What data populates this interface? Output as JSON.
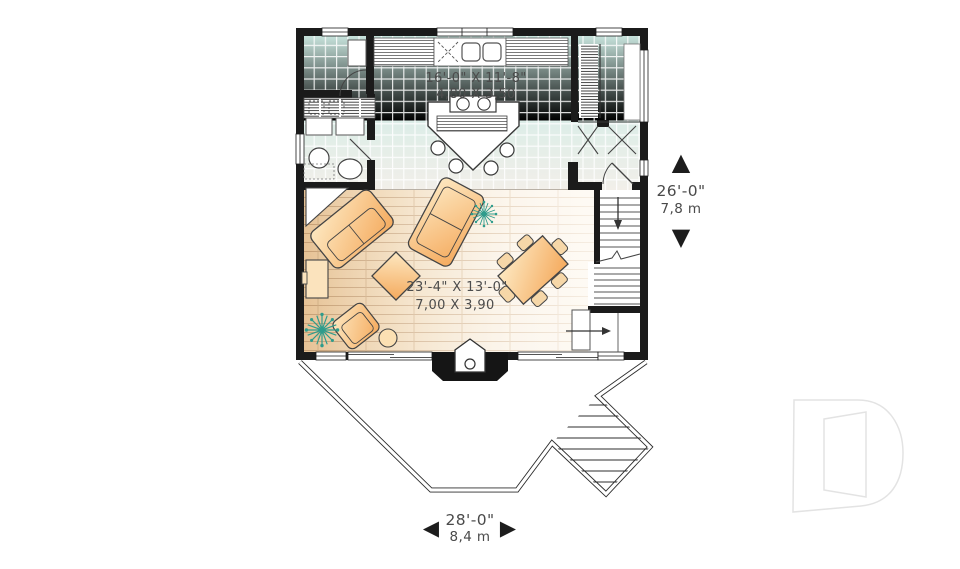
{
  "plan": {
    "rooms": [
      {
        "name": "kitchen-dining",
        "size_imperial": "16'-0\" X 11'-8\"",
        "size_metric": "4,80 X 3,50"
      },
      {
        "name": "living-room",
        "size_imperial": "23'-4\" X 13'-0\"",
        "size_metric": "7,00 X 3,90"
      }
    ],
    "overall_depth": {
      "imperial": "26'-0\"",
      "metric": "7,8 m"
    },
    "overall_width": {
      "imperial": "28'-0\"",
      "metric": "8,4 m"
    }
  },
  "icons": {
    "up_arrow": "▲",
    "down_arrow": "▼",
    "left_arrow": "◀",
    "right_arrow": "▶",
    "watermark": "drummond-d-logo"
  },
  "colors": {
    "wall": "#1b1b1b",
    "tile": "#cde6e0",
    "wood": "#e8c497",
    "furniture": "#f6b26b",
    "plant": "#2f9c8c",
    "text": "#4a4a4a",
    "watermark": "#e3e3e3"
  }
}
